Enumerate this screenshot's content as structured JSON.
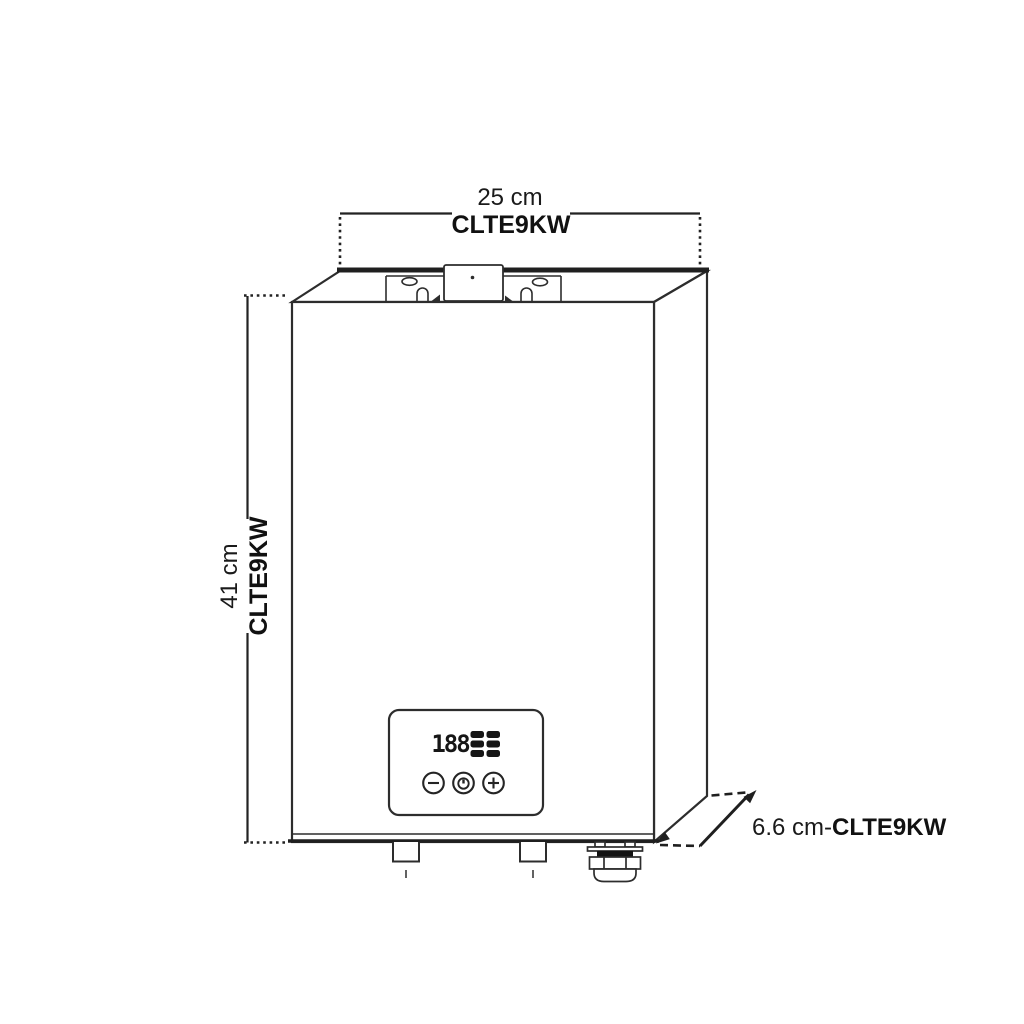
{
  "labels": {
    "width": {
      "value": "25 cm",
      "model": "CLTE9KW"
    },
    "height": {
      "value": "41 cm",
      "model": "CLTE9KW"
    },
    "depth": {
      "value": "6.6 cm",
      "separator": "-",
      "model": "CLTE9KW"
    }
  },
  "display": {
    "digits": "188"
  },
  "icons": {
    "minus_button": "minus-in-circle",
    "power_button": "power-in-circle",
    "plus_button": "plus-in-circle",
    "indicator_blocks": "lcd-segment-blocks"
  },
  "colors": {
    "background": "#ffffff",
    "line": "#2d2d2d",
    "text": "#1a1a1a",
    "segment": "#141414"
  }
}
